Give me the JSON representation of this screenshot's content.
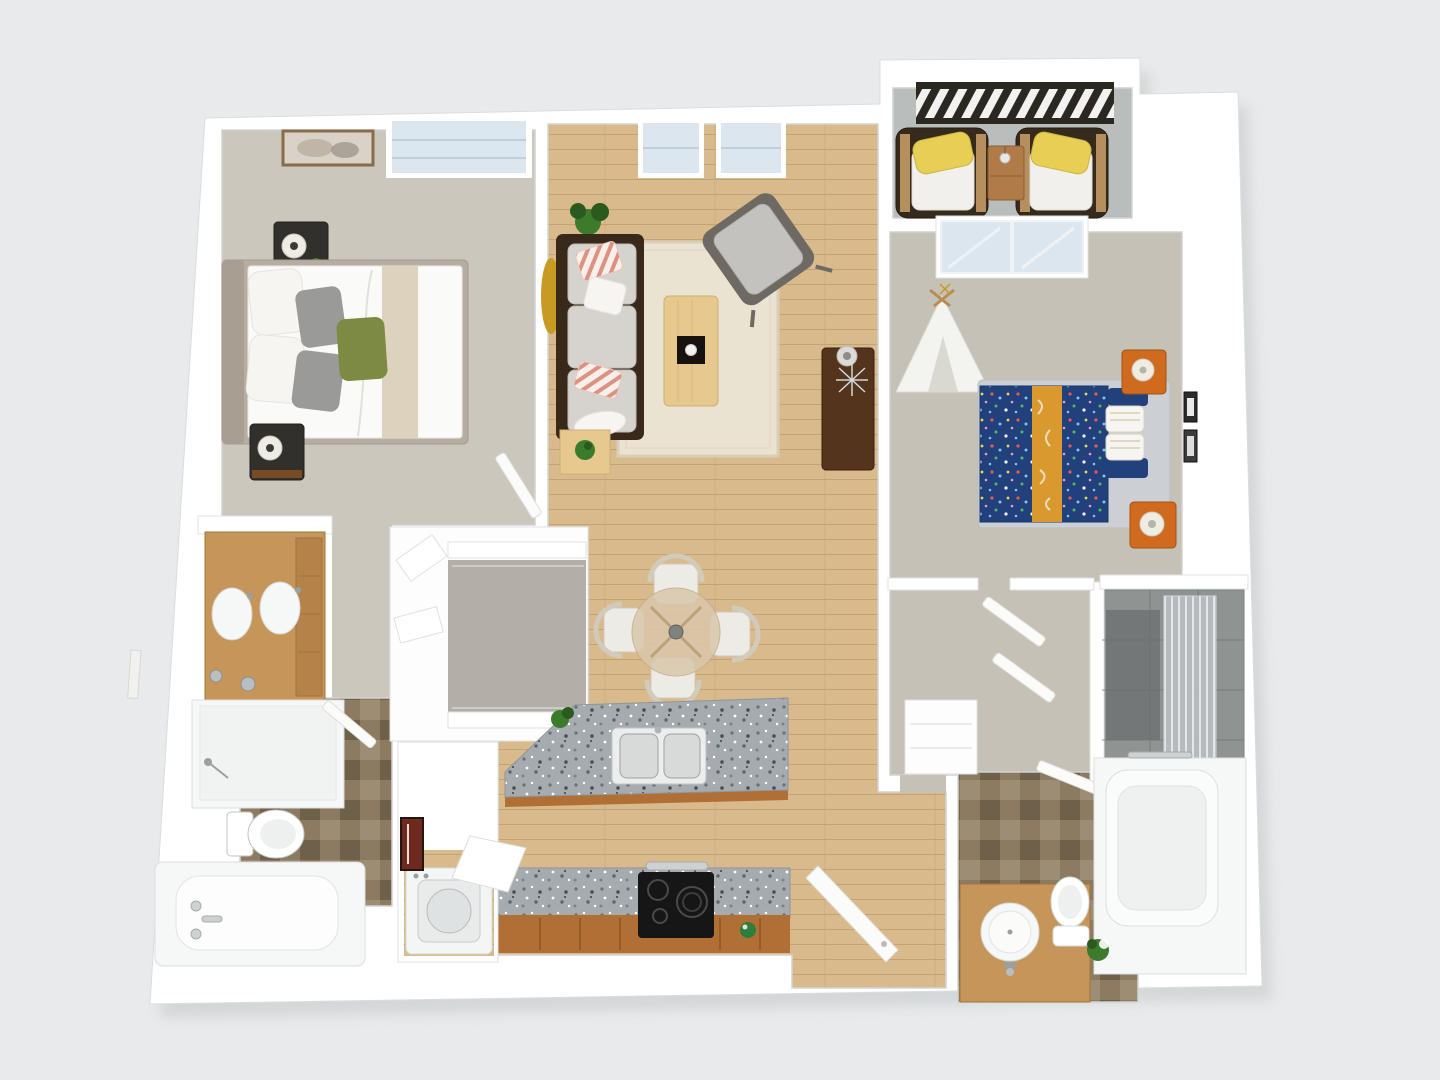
{
  "scene": {
    "title": "3D top-down floor plan rendering of a two-bedroom, two-bathroom apartment with balcony",
    "type": "3d-floor-plan-top-view",
    "no_visible_text": true
  },
  "colors": {
    "bg": "#e8eaeb",
    "plateShadow": "#c4c7c8",
    "plate": "#ffffff",
    "wallLine": "#e0e1e2",
    "carpet1": "#cbc7bd",
    "carpet2": "#c5c1b7",
    "closetCarpet": "#b3afa6",
    "wood": "#d9ba8c",
    "woodLine": "#c6a271",
    "rug": "#eae3d1",
    "rugEdge": "#d9cfb8",
    "sofaFrame": "#38291b",
    "sofaCushion": "#d6d3cf",
    "cushionEdge": "#bfbcb6",
    "pillowWhite": "#f6f5f1",
    "pillowGray": "#9a9a98",
    "pillowGreen": "#7d8a44",
    "stripeBase": "#f7f0ea",
    "stripePink": "#dd9183",
    "bedFrame": "#b7aea1",
    "headboard": "#a89f92",
    "duvet": "#fafaf8",
    "duvetStripe": "#ddd2bd",
    "nightstand": "#32302d",
    "nightstandWood": "#7a4a22",
    "lamp": "#efece4",
    "lampDark": "#3a3a38",
    "gold": "#c79a22",
    "glass": "#dce6ee",
    "glassSill": "#c2cfda",
    "plantGreen": "#3c7a2c",
    "plantDark": "#2a5a1e",
    "coffeeTable": "#e7c98f",
    "tableEdge": "#cfae72",
    "tray": "#17120d",
    "armFrame": "#6e6a63",
    "armCushion": "#c4c2be",
    "console": "#54341d",
    "consoleEdge": "#371f0e",
    "concrete": "#b9bdbc",
    "railing": "#2b2721",
    "patioChair": "#362a1d",
    "patioCushion": "#f1f0ec",
    "patioYellow": "#e6cf54",
    "patioWood": "#c59a66",
    "patioTable": "#b07b49",
    "navy": "#21407c",
    "mustard": "#d9992e",
    "bedPlatform": "#ccd0d4",
    "orange": "#cf6a1f",
    "orangeEdge": "#a45113",
    "teepee": "#f3f3f0",
    "teepeeShade": "#d9d9d2",
    "tileA": "#8c7b61",
    "tileB": "#6f604a",
    "tileC": "#9c8d74",
    "vanityTan": "#c6955a",
    "vanityEdge": "#a3743a",
    "vanityDrawer": "#b5824a",
    "granite": "#a6abb0",
    "cabinet": "#b06f35",
    "cabinetEdge": "#8f5520",
    "cooktop": "#161616",
    "steel": "#ced1d2",
    "steelEdge": "#a7abac",
    "fixWhite": "#f6f7f7",
    "fixStroke": "#dcdedf",
    "showerTile": "#8f9392",
    "showerDark": "#6d7170",
    "chairWhite": "#edebe6",
    "chairEdge": "#d2caba",
    "tableGlass": "#d9c8ab",
    "tableGlassEdge": "#c4ae85",
    "doorWhite": "#fbfbfa",
    "doorEdge": "#dfdfdc",
    "frameDark": "#2c2c2c",
    "frameRed": "#6e2a1e",
    "white": "#ffffff"
  },
  "rooms": [
    {
      "name": "bedroom-1",
      "floor": "carpet"
    },
    {
      "name": "living-room",
      "floor": "hardwood"
    },
    {
      "name": "dining-area",
      "floor": "hardwood"
    },
    {
      "name": "kitchen",
      "floor": "hardwood"
    },
    {
      "name": "entry",
      "floor": "hardwood"
    },
    {
      "name": "balcony",
      "floor": "concrete"
    },
    {
      "name": "bedroom-2",
      "floor": "carpet"
    },
    {
      "name": "bathroom-1",
      "floor": "brown-tile"
    },
    {
      "name": "bathroom-2",
      "floor": "brown-tile"
    },
    {
      "name": "walk-in-closet",
      "floor": "carpet"
    },
    {
      "name": "laundry-closet",
      "floor": "hardwood"
    },
    {
      "name": "shower-room",
      "floor": "gray-tile"
    }
  ],
  "furniture": {
    "bedroom_1": [
      "double-bed-white-duvet",
      "green-and-gray-accent-pillows",
      "nightstand-with-lamp",
      "nightstand-with-lamp",
      "wall-art",
      "window",
      "gold-round-mirror"
    ],
    "bathroom_1": [
      "double-sink-wood-vanity",
      "walk-in-shower",
      "toilet",
      "bathtub-with-fixtures"
    ],
    "walk_in_closet": [
      "shelving-with-rods",
      "corner-shelves"
    ],
    "living_room": [
      "three-seat-sofa",
      "coral-striped-pillows",
      "side-table-with-plant",
      "area-rug",
      "wood-coffee-table-with-tray",
      "gray-armchair",
      "walnut-console-with-lamp",
      "potted-plant",
      "two-windows"
    ],
    "dining_area": [
      "round-glass-table",
      "four-white-chairs",
      "centerpiece"
    ],
    "kitchen": [
      "granite-island-with-double-sink",
      "herb-plant",
      "granite-counter",
      "black-cooktop",
      "oven-handle",
      "wood-cabinets",
      "green-bowl"
    ],
    "laundry_closet": [
      "top-load-washer-lid-open",
      "framed-picture"
    ],
    "balcony": [
      "slatted-dark-railing",
      "patio-armchair-yellow-pillow",
      "patio-armchair-yellow-pillow",
      "wood-side-table-with-vase",
      "sliding-glass-door"
    ],
    "bedroom_2": [
      "double-bed-navy-confetti-duvet",
      "mustard-stripe",
      "striped-pillows",
      "orange-nightstand-with-lamp",
      "orange-nightstand-with-lamp",
      "white-teepee-tent",
      "two-wall-frames",
      "bifold-closet-doors"
    ],
    "bathroom_2": [
      "wood-vanity-round-sink",
      "toilet",
      "bathtub-with-towel-bar",
      "gray-tile-shower-with-glass",
      "plant",
      "linen-closet"
    ],
    "entry": [
      "open-front-door"
    ]
  }
}
